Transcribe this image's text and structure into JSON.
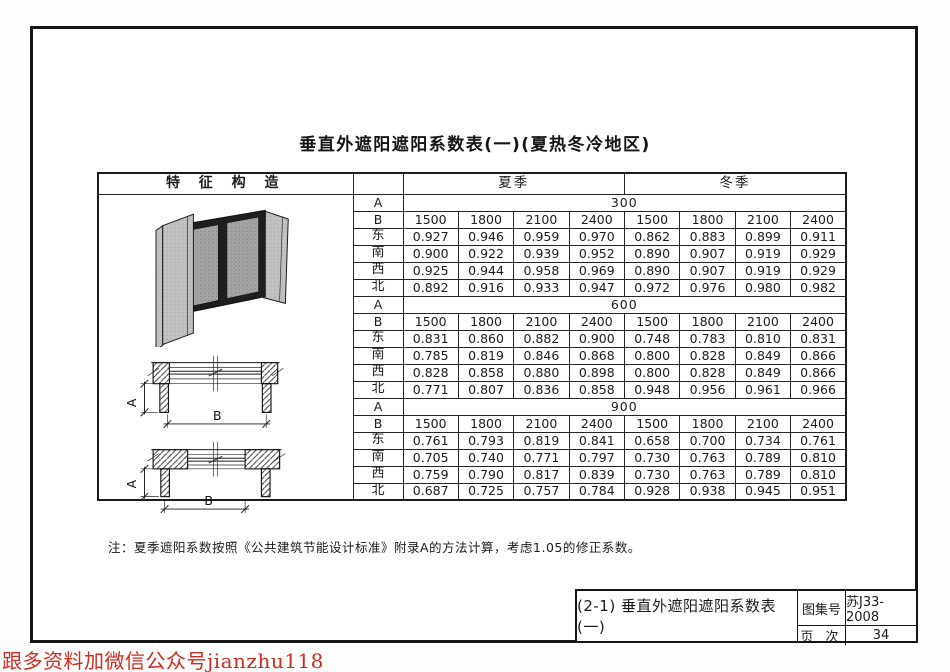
{
  "page": {
    "title": "垂直外遮阳遮阳系数表(一)(夏热冬冷地区)",
    "note": "注：夏季遮阳系数按照《公共建筑节能设计标准》附录A的方法计算，考虑1.05的修正系数。",
    "watermark": "跟多资料加微信公众号jianzhu118"
  },
  "title_block": {
    "figure_label": "(2-1)  垂直外遮阳遮阳系数表(一)",
    "atlas_no_label": "图集号",
    "atlas_no_value": "苏J33-2008",
    "page_no_label": "页 次",
    "page_no_value": "34"
  },
  "drawings": {
    "dim_a": "A",
    "dim_b": "B"
  },
  "table": {
    "feature_header": "特 征 构 造",
    "season_headers": [
      "夏季",
      "冬季"
    ],
    "a_label": "A",
    "b_label": "B",
    "b_values": [
      "1500",
      "1800",
      "2100",
      "2400",
      "1500",
      "1800",
      "2100",
      "2400"
    ],
    "sections": [
      {
        "a": "300",
        "rows": [
          {
            "dir": "东",
            "values": [
              "0.927",
              "0.946",
              "0.959",
              "0.970",
              "0.862",
              "0.883",
              "0.899",
              "0.911"
            ]
          },
          {
            "dir": "南",
            "values": [
              "0.900",
              "0.922",
              "0.939",
              "0.952",
              "0.890",
              "0.907",
              "0.919",
              "0.929"
            ]
          },
          {
            "dir": "西",
            "values": [
              "0.925",
              "0.944",
              "0.958",
              "0.969",
              "0.890",
              "0.907",
              "0.919",
              "0.929"
            ]
          },
          {
            "dir": "北",
            "values": [
              "0.892",
              "0.916",
              "0.933",
              "0.947",
              "0.972",
              "0.976",
              "0.980",
              "0.982"
            ]
          }
        ]
      },
      {
        "a": "600",
        "rows": [
          {
            "dir": "东",
            "values": [
              "0.831",
              "0.860",
              "0.882",
              "0.900",
              "0.748",
              "0.783",
              "0.810",
              "0.831"
            ]
          },
          {
            "dir": "南",
            "values": [
              "0.785",
              "0.819",
              "0.846",
              "0.868",
              "0.800",
              "0.828",
              "0.849",
              "0.866"
            ]
          },
          {
            "dir": "西",
            "values": [
              "0.828",
              "0.858",
              "0.880",
              "0.898",
              "0.800",
              "0.828",
              "0.849",
              "0.866"
            ]
          },
          {
            "dir": "北",
            "values": [
              "0.771",
              "0.807",
              "0.836",
              "0.858",
              "0.948",
              "0.956",
              "0.961",
              "0.966"
            ]
          }
        ]
      },
      {
        "a": "900",
        "rows": [
          {
            "dir": "东",
            "values": [
              "0.761",
              "0.793",
              "0.819",
              "0.841",
              "0.658",
              "0.700",
              "0.734",
              "0.761"
            ]
          },
          {
            "dir": "南",
            "values": [
              "0.705",
              "0.740",
              "0.771",
              "0.797",
              "0.730",
              "0.763",
              "0.789",
              "0.810"
            ]
          },
          {
            "dir": "西",
            "values": [
              "0.759",
              "0.790",
              "0.817",
              "0.839",
              "0.730",
              "0.763",
              "0.789",
              "0.810"
            ]
          },
          {
            "dir": "北",
            "values": [
              "0.687",
              "0.725",
              "0.757",
              "0.784",
              "0.928",
              "0.938",
              "0.945",
              "0.951"
            ]
          }
        ]
      }
    ]
  },
  "colors": {
    "ink": "#1b1b1b",
    "watermark_red": "#cf2b20"
  }
}
